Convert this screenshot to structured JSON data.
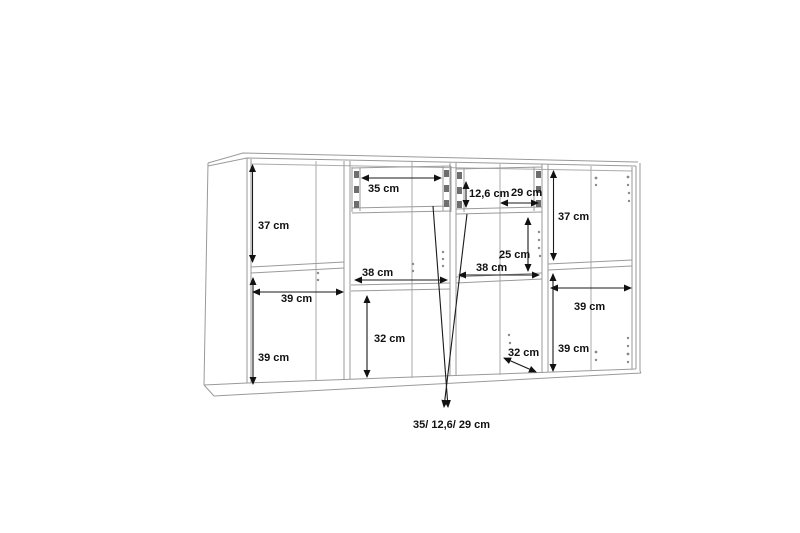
{
  "diagram": {
    "type": "furniture-dimension-drawing",
    "subject": "sideboard-wall-cabinet-with-four-compartments-and-two-drawers",
    "unit": "cm",
    "colors": {
      "background": "#ffffff",
      "cabinet_line": "#9a9a9a",
      "dimension_line": "#1a1a1a",
      "label_text": "#111111"
    },
    "annotations": [
      {
        "id": "left-upper-height",
        "text": "37 cm",
        "value": 37,
        "orientation": "vertical",
        "section": "left compartment upper"
      },
      {
        "id": "left-width",
        "text": "39 ccm",
        "value": 39,
        "orientation": "horizontal",
        "section": "left compartment"
      },
      {
        "id": "left-lower-height",
        "text": "39 cm",
        "value": 39,
        "orientation": "vertical",
        "section": "left compartment lower"
      },
      {
        "id": "drawer-left-width",
        "text": "35 cm",
        "value": 35,
        "orientation": "horizontal",
        "section": "left drawer"
      },
      {
        "id": "mid-left-width",
        "text": "38 cm",
        "value": 38,
        "orientation": "horizontal",
        "section": "middle-left compartment"
      },
      {
        "id": "mid-left-height",
        "text": "32 cm",
        "value": 32,
        "orientation": "vertical",
        "section": "middle-left compartment lower"
      },
      {
        "id": "drawer-right-height",
        "text": "12,6 cm",
        "value": 12.6,
        "orientation": "vertical",
        "section": "right drawer"
      },
      {
        "id": "drawer-right-width",
        "text": "29 cm",
        "value": 29,
        "orientation": "horizontal",
        "section": "right drawer"
      },
      {
        "id": "mid-right-height",
        "text": "25 cm",
        "value": 25,
        "orientation": "vertical",
        "section": "middle-right compartment"
      },
      {
        "id": "mid-right-width",
        "text": "38 cm",
        "value": 38,
        "orientation": "horizontal",
        "section": "middle-right compartment"
      },
      {
        "id": "depth",
        "text": "32 cm",
        "value": 32,
        "orientation": "diagonal",
        "section": "cabinet depth"
      },
      {
        "id": "right-upper-height",
        "text": "37 cm",
        "value": 37,
        "orientation": "vertical",
        "section": "right compartment upper"
      },
      {
        "id": "right-width",
        "text": "39 cm",
        "value": 39,
        "orientation": "horizontal",
        "section": "right compartment"
      },
      {
        "id": "right-lower-height",
        "text": "39 cm",
        "value": 39,
        "orientation": "vertical",
        "section": "right compartment lower"
      },
      {
        "id": "drawer-summary",
        "text": "35/ 12,6/ 29 cm",
        "orientation": "callout",
        "section": "drawer inner dimensions"
      }
    ]
  }
}
